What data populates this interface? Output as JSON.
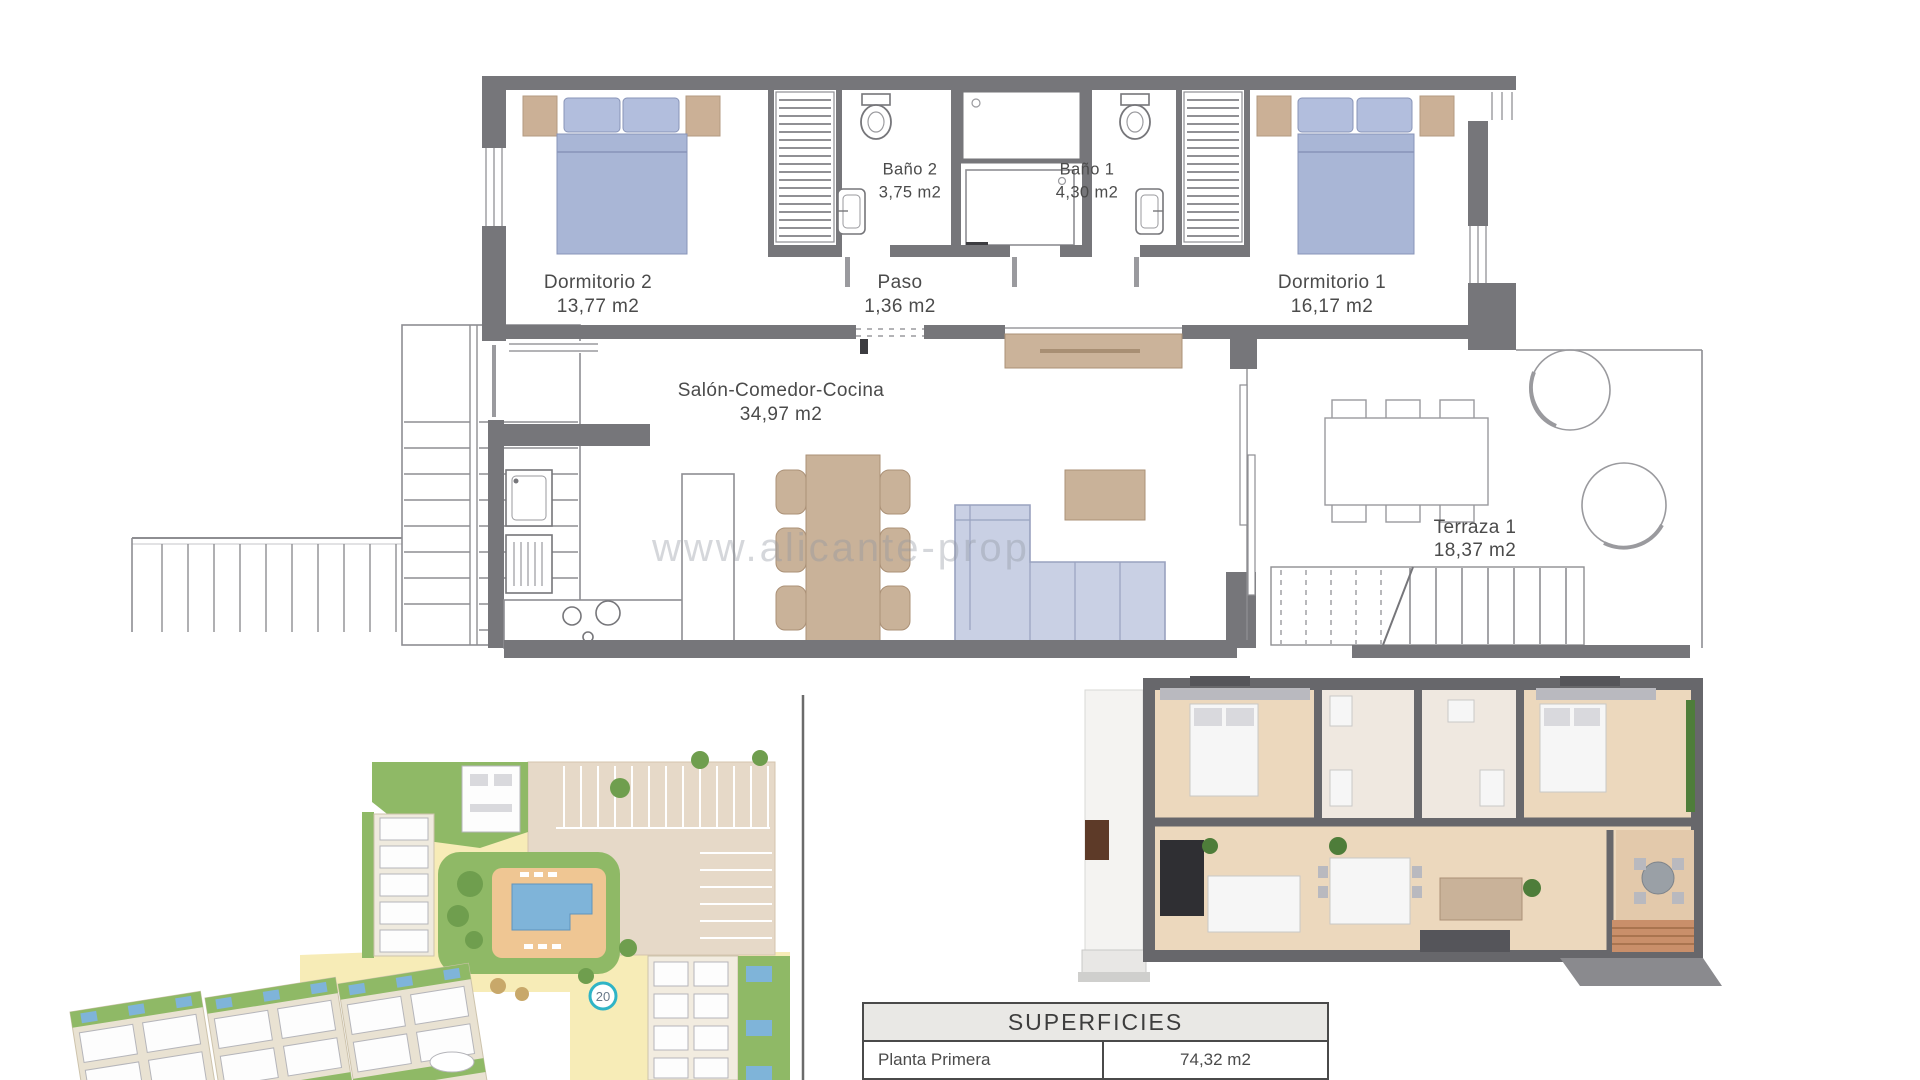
{
  "floor_plan": {
    "rooms": {
      "dormitorio2": {
        "name": "Dormitorio 2",
        "area": "13,77 m2"
      },
      "bano2": {
        "name": "Baño 2",
        "area": "3,75 m2"
      },
      "bano1": {
        "name": "Baño 1",
        "area": "4,30 m2"
      },
      "paso": {
        "name": "Paso",
        "area": "1,36 m2"
      },
      "dormitorio1": {
        "name": "Dormitorio 1",
        "area": "16,17 m2"
      },
      "salon": {
        "name": "Salón-Comedor-Cocina",
        "area": "34,97 m2"
      },
      "terraza": {
        "name": "Terraza 1",
        "area": "18,37 m2"
      }
    }
  },
  "watermark": "www.alicante-prop",
  "site_plan": {
    "unit_badge": "20"
  },
  "superficies": {
    "title": "SUPERFICIES",
    "rows": [
      {
        "label": "Planta Primera",
        "value": "74,32 m2"
      },
      {
        "label": "Terraza 1",
        "value": "18,37 m2"
      }
    ]
  },
  "colors": {
    "wall_gray": "#76767a",
    "bed_blue": "#a9b6d6",
    "furniture_tan": "#cbb096",
    "sofa_blue": "#c9d0e4",
    "site_green": "#8fb966",
    "site_yellow": "#f7ecb7",
    "parking_beige": "#e6d9c8",
    "pool_blue": "#7fb4d9",
    "badge_teal": "#2fb4c6"
  }
}
